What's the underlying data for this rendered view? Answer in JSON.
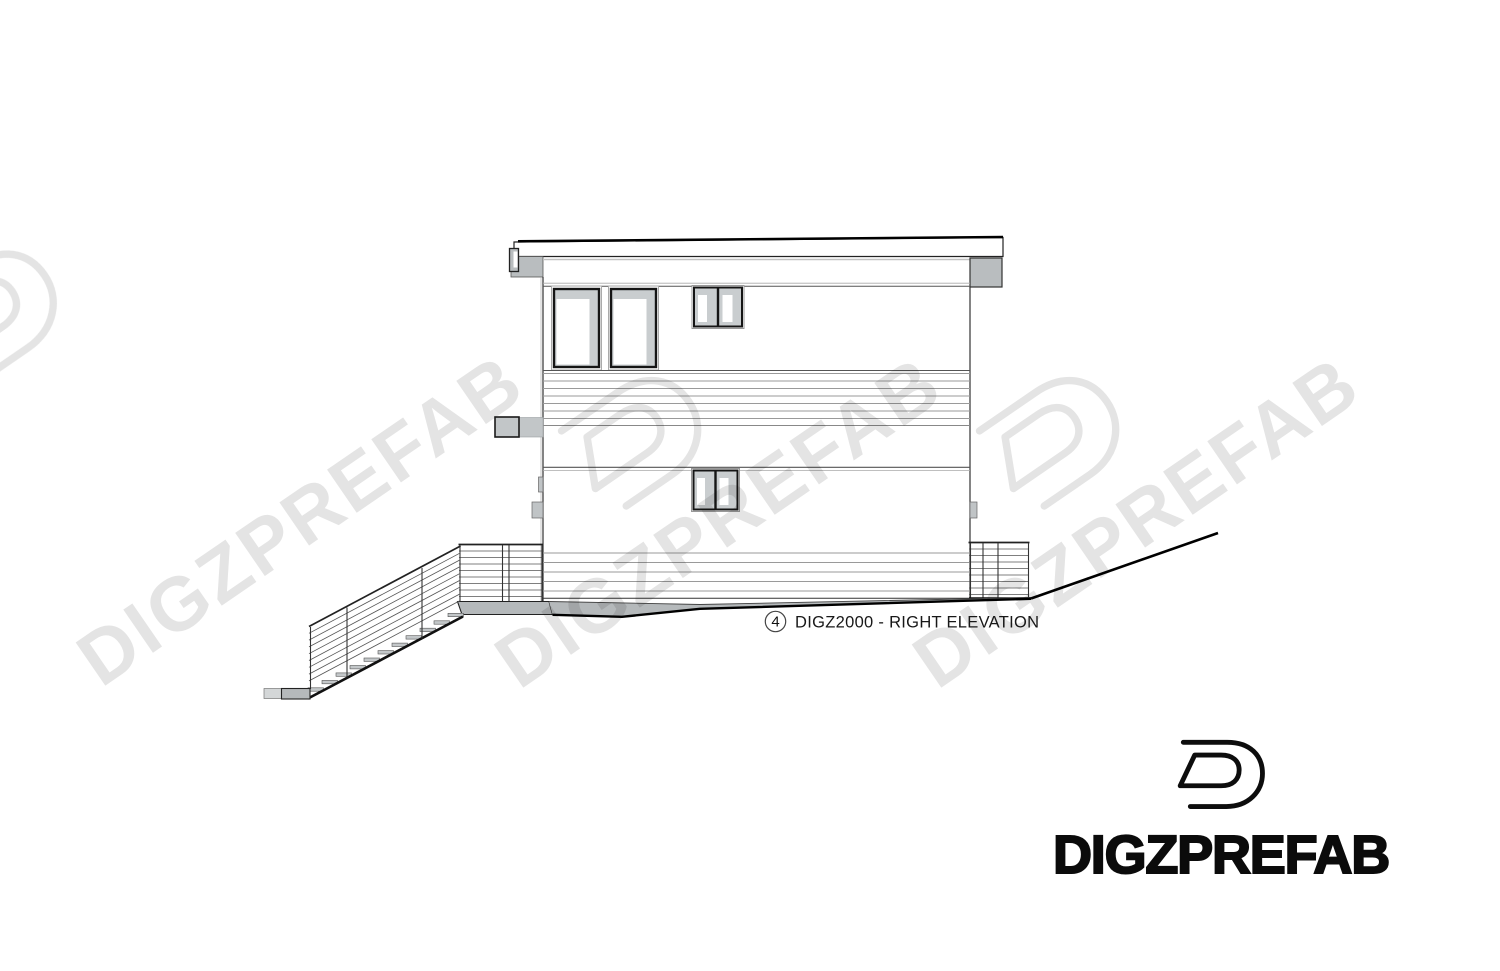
{
  "sheet": {
    "view_label": {
      "number": "4",
      "title": "DIGZ2000 - RIGHT ELEVATION"
    }
  },
  "branding": {
    "wordmark": "DIGZPREFAB",
    "logo_icon": "digzprefab-d-logo"
  },
  "watermark": {
    "text": "DIGZPREFAB"
  },
  "colors": {
    "paper": "#ffffff",
    "line": "#1a1a1a",
    "fascia_gray": "#b9bdbf",
    "slab_gray": "#b5b9bb",
    "glass_gray": "#c9cdcf",
    "tread_gray": "#c3c7c9",
    "watermark_gray": "#e4e4e4"
  }
}
